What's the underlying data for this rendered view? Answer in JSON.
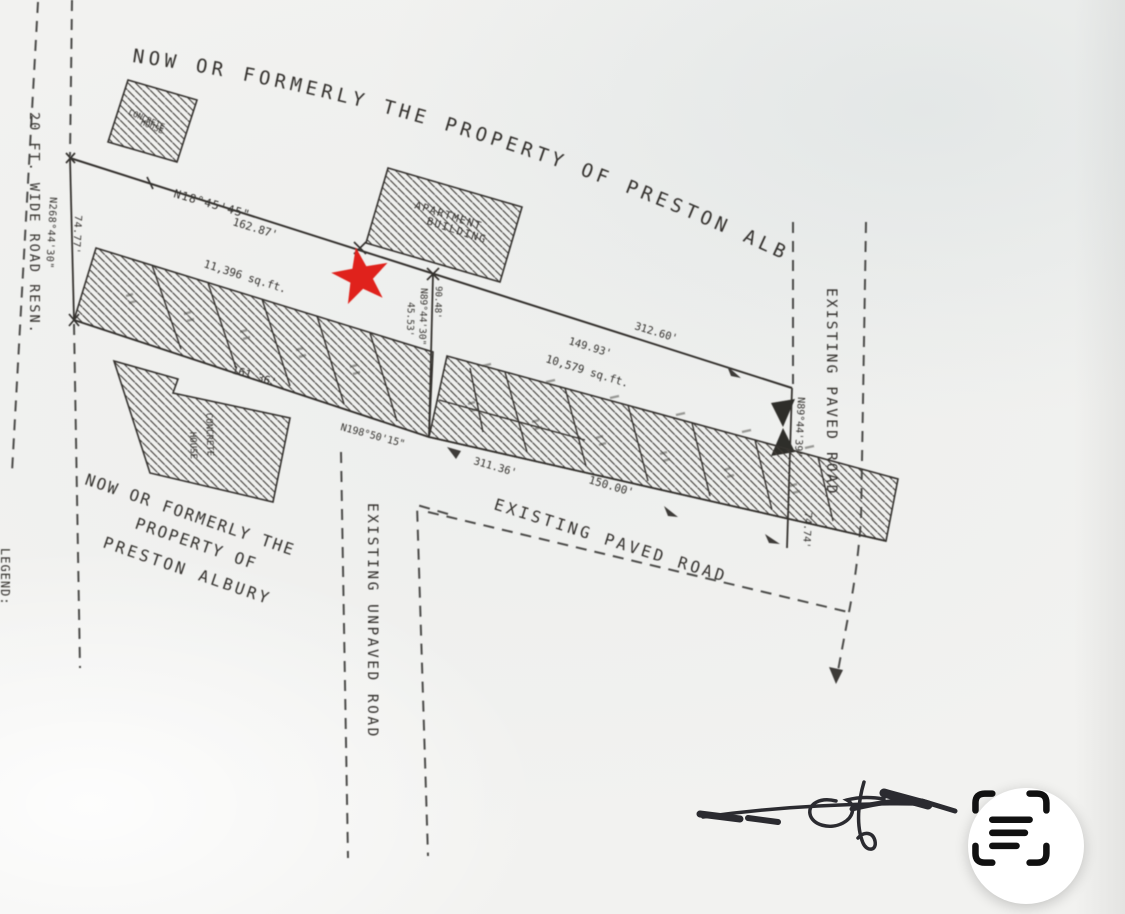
{
  "plat": {
    "arc_owner_label": "NOW OR FORMERLY THE PROPERTY OF PRESTON ALBURY",
    "southwest_owner": {
      "line1": "NOW OR FORMERLY THE",
      "line2": "PROPERTY OF",
      "line3": "PRESTON ALBURY"
    },
    "buildings": {
      "concrete_house_north": {
        "line1": "CONCRETE",
        "line2": "HOUSE"
      },
      "apartment_building": {
        "line1": "APARTMENT",
        "line2": "BUILDING"
      },
      "concrete_house_south": {
        "line1": "CONCRETE",
        "line2": "HOUSE"
      }
    },
    "roads": {
      "west_road_reservation": "20 FT. WIDE ROAD RESN.",
      "unpaved_road": "EXISTING UNPAVED ROAD",
      "south_paved_road": "EXISTING PAVED ROAD",
      "east_paved_road": "EXISTING PAVED ROAD"
    },
    "parcel_areas": {
      "north_parcel": "11,396 sq.ft.",
      "south_parcel": "10,579 sq.ft."
    },
    "dimensions": {
      "north_bearing": "N18°45'45\"",
      "north_distance": "162.87'",
      "west_bearing": "N268°44'30\"",
      "west_distance": "74.77'",
      "center_bearing": "N89°44'30\"",
      "center_distance_upper": "90.48'",
      "center_distance_lower": "45.53'",
      "southwest_bearing": "N198°50'15\"",
      "north_strip_south_distance": "161.36'",
      "south_distance_total": "311.36'",
      "south_distance_part": "150.00'",
      "northeast_distance_part": "149.93'",
      "northeast_distance_total": "312.60'",
      "east_bearing": "N89°44'39\"",
      "east_distance": "74.74'"
    },
    "legend_label": "LEGEND:",
    "marker": {
      "color": "#e0231a"
    }
  }
}
